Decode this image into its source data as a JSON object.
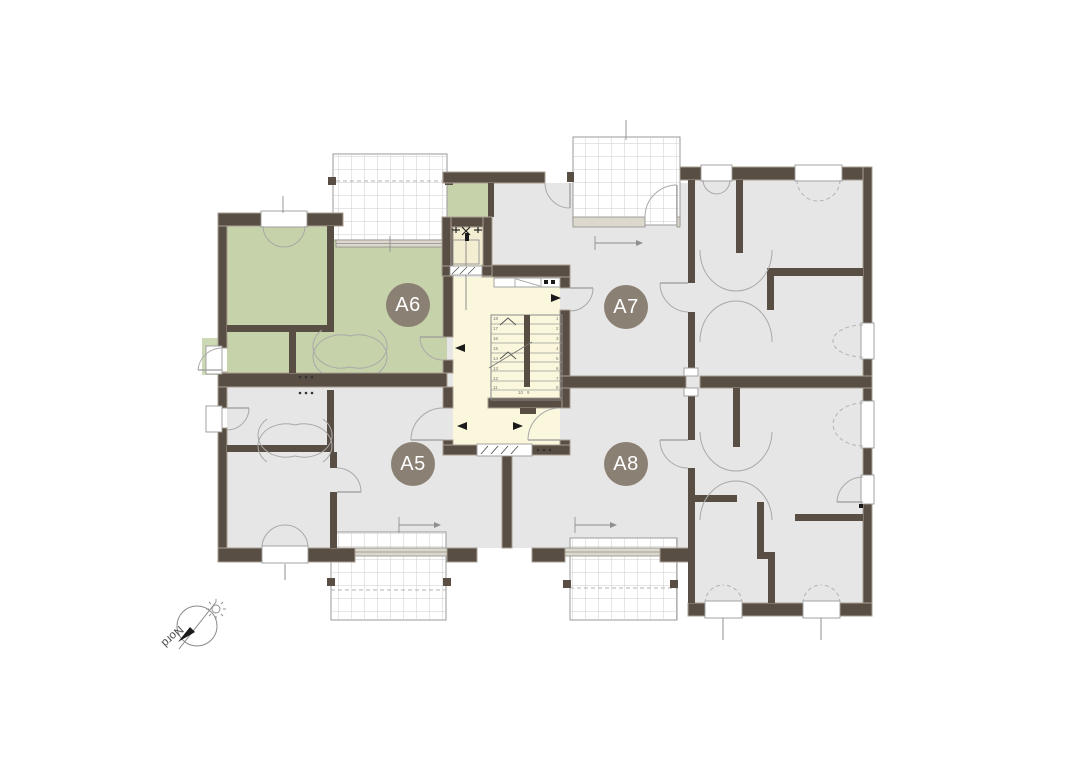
{
  "floor_plan": {
    "apartments": [
      {
        "id": "a6",
        "label": "A6",
        "highlighted": true
      },
      {
        "id": "a7",
        "label": "A7",
        "highlighted": false
      },
      {
        "id": "a5",
        "label": "A5",
        "highlighted": false
      },
      {
        "id": "a8",
        "label": "A8",
        "highlighted": false
      }
    ],
    "compass": {
      "label": "Nord"
    },
    "stairs": {
      "left_numbers": [
        "18",
        "17",
        "16",
        "15",
        "14",
        "13",
        "12",
        "11"
      ],
      "right_numbers": [
        "1",
        "2",
        "3",
        "4",
        "5",
        "6",
        "7",
        "8"
      ],
      "bottom_numbers": [
        "10",
        "9"
      ]
    },
    "colors": {
      "badge": "#8b8074",
      "badge_text": "#ffffff",
      "highlight_green": "#c6d2a9",
      "porch_green": "#cdd8b4",
      "room_gray": "#e6e6e6",
      "stairwell_yellow": "#faf7dc",
      "elevator_yellow": "#f3eed2",
      "wall_brown": "#584e44",
      "wall_casing": "#a99f92",
      "background": "#ffffff"
    }
  }
}
